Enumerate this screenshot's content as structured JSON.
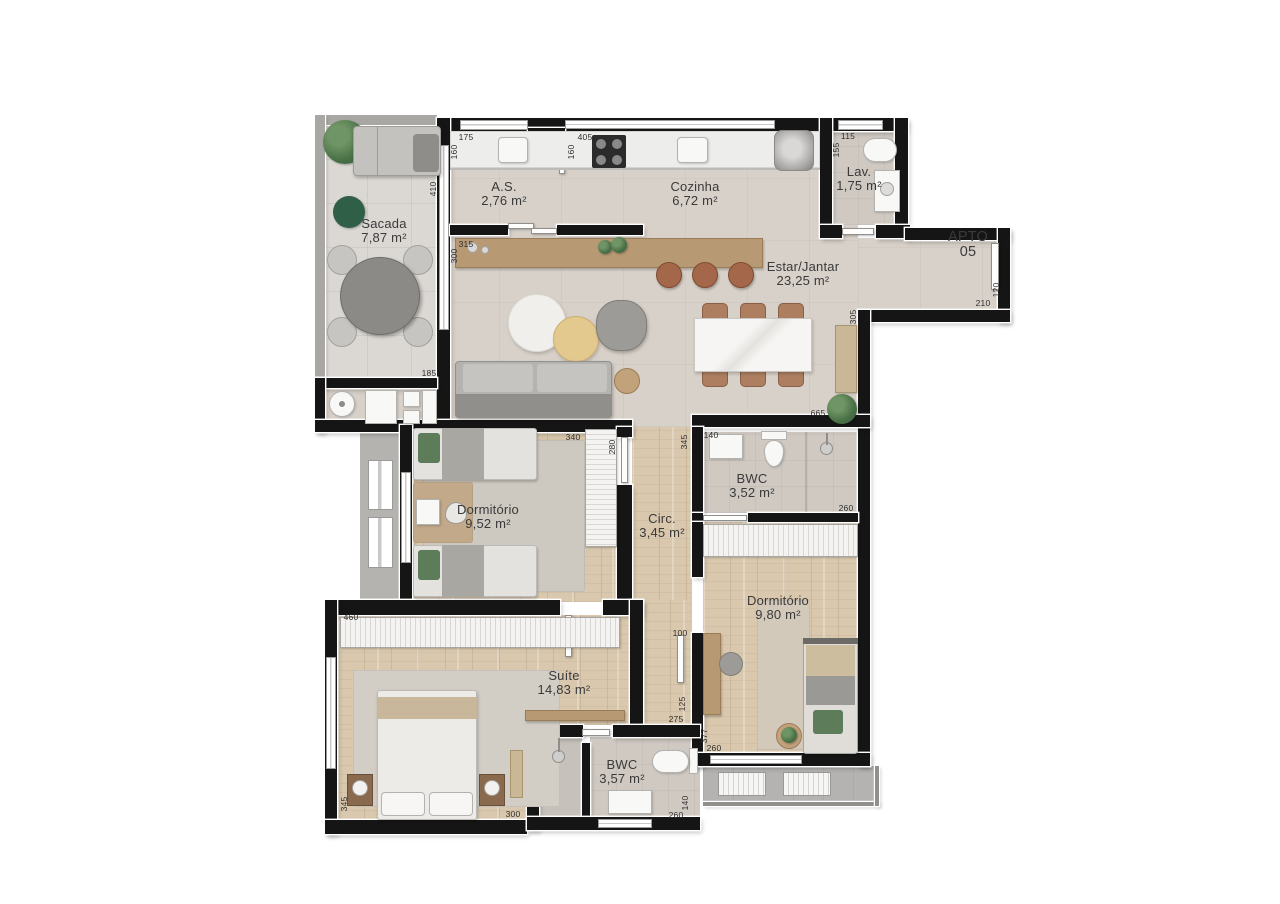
{
  "plan": {
    "entry": {
      "label_line1": "APTO",
      "label_line2": "05"
    },
    "rooms": [
      {
        "id": "sacada",
        "name": "Sacada",
        "area": "7,87 m²"
      },
      {
        "id": "as",
        "name": "A.S.",
        "area": "2,76 m²"
      },
      {
        "id": "cozinha",
        "name": "Cozinha",
        "area": "6,72 m²"
      },
      {
        "id": "lavabo",
        "name": "Lav.",
        "area": "1,75 m²"
      },
      {
        "id": "estar-jantar",
        "name": "Estar/Jantar",
        "area": "23,25 m²"
      },
      {
        "id": "dormitorio-1",
        "name": "Dormitório",
        "area": "9,52 m²"
      },
      {
        "id": "circulacao",
        "name": "Circ.",
        "area": "3,45 m²"
      },
      {
        "id": "bwc-social",
        "name": "BWC",
        "area": "3,52 m²"
      },
      {
        "id": "dormitorio-2",
        "name": "Dormitório",
        "area": "9,80 m²"
      },
      {
        "id": "suite",
        "name": "Suíte",
        "area": "14,83 m²"
      },
      {
        "id": "bwc-suite",
        "name": "BWC",
        "area": "3,57 m²"
      }
    ],
    "dimensions_cm": [
      {
        "text": "175",
        "x": 151,
        "y": 25,
        "v": false
      },
      {
        "text": "160",
        "x": 139,
        "y": 40,
        "v": true
      },
      {
        "text": "405",
        "x": 270,
        "y": 25,
        "v": false
      },
      {
        "text": "160",
        "x": 256,
        "y": 40,
        "v": true
      },
      {
        "text": "115",
        "x": 533,
        "y": 24,
        "v": false
      },
      {
        "text": "155",
        "x": 521,
        "y": 38,
        "v": true
      },
      {
        "text": "410",
        "x": 118,
        "y": 77,
        "v": true
      },
      {
        "text": "315",
        "x": 151,
        "y": 132,
        "v": false
      },
      {
        "text": "300",
        "x": 139,
        "y": 144,
        "v": true
      },
      {
        "text": "185",
        "x": 114,
        "y": 261,
        "v": false
      },
      {
        "text": "120",
        "x": 681,
        "y": 178,
        "v": true
      },
      {
        "text": "210",
        "x": 668,
        "y": 191,
        "v": false
      },
      {
        "text": "305",
        "x": 538,
        "y": 205,
        "v": true
      },
      {
        "text": "665",
        "x": 503,
        "y": 301,
        "v": false
      },
      {
        "text": "340",
        "x": 258,
        "y": 325,
        "v": false
      },
      {
        "text": "280",
        "x": 297,
        "y": 335,
        "v": true
      },
      {
        "text": "345",
        "x": 369,
        "y": 330,
        "v": true
      },
      {
        "text": "140",
        "x": 396,
        "y": 323,
        "v": false
      },
      {
        "text": "260",
        "x": 531,
        "y": 396,
        "v": false
      },
      {
        "text": "460",
        "x": 36,
        "y": 505,
        "v": false
      },
      {
        "text": "100",
        "x": 365,
        "y": 521,
        "v": false
      },
      {
        "text": "125",
        "x": 367,
        "y": 592,
        "v": true
      },
      {
        "text": "275",
        "x": 361,
        "y": 607,
        "v": false
      },
      {
        "text": "377",
        "x": 389,
        "y": 624,
        "v": true
      },
      {
        "text": "260",
        "x": 399,
        "y": 636,
        "v": false
      },
      {
        "text": "345",
        "x": 29,
        "y": 692,
        "v": true
      },
      {
        "text": "300",
        "x": 198,
        "y": 702,
        "v": false
      },
      {
        "text": "140",
        "x": 370,
        "y": 691,
        "v": true
      },
      {
        "text": "260",
        "x": 361,
        "y": 703,
        "v": false
      }
    ],
    "colors": {
      "wall": "#151515",
      "floor_balcony": "#dbd8d4",
      "floor_social": "#d8d1c9",
      "floor_wood": "#d9c8ae",
      "floor_bath": "#d0c9c2",
      "accent_green": "#4a7247",
      "label_text": "#3a3a3a"
    }
  }
}
